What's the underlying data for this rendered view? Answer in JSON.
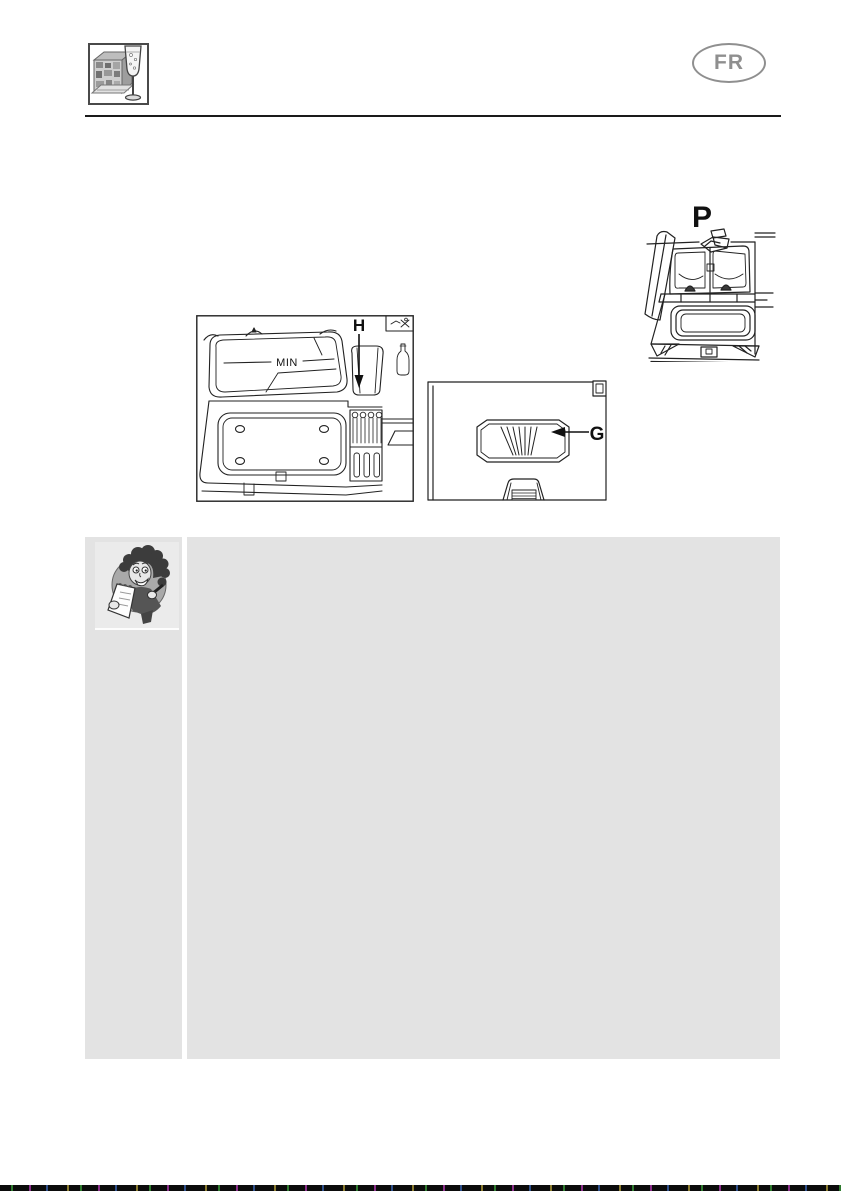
{
  "header": {
    "logo_icon": "dishwasher-with-wine-glass-icon",
    "language_badge": "FR"
  },
  "figures": {
    "fig_p": {
      "label": "P",
      "icon": "detergent-dispenser-open-lid-diagram"
    },
    "fig_h": {
      "label": "H",
      "min_marking": "MIN",
      "icon": "detergent-dispenser-fill-level-diagram"
    },
    "fig_g": {
      "label": "G",
      "icon": "door-vent-slider-diagram"
    }
  },
  "note_panel": {
    "mascot_icon": "woman-with-notepad-icon"
  },
  "colors": {
    "panel_gray": "#e3e3e3",
    "mascot_panel_gray": "#ebebeb",
    "badge_gray": "#8f8f8f",
    "header_rule_black": "#1a1a1a",
    "diagram_line": "#222222"
  }
}
